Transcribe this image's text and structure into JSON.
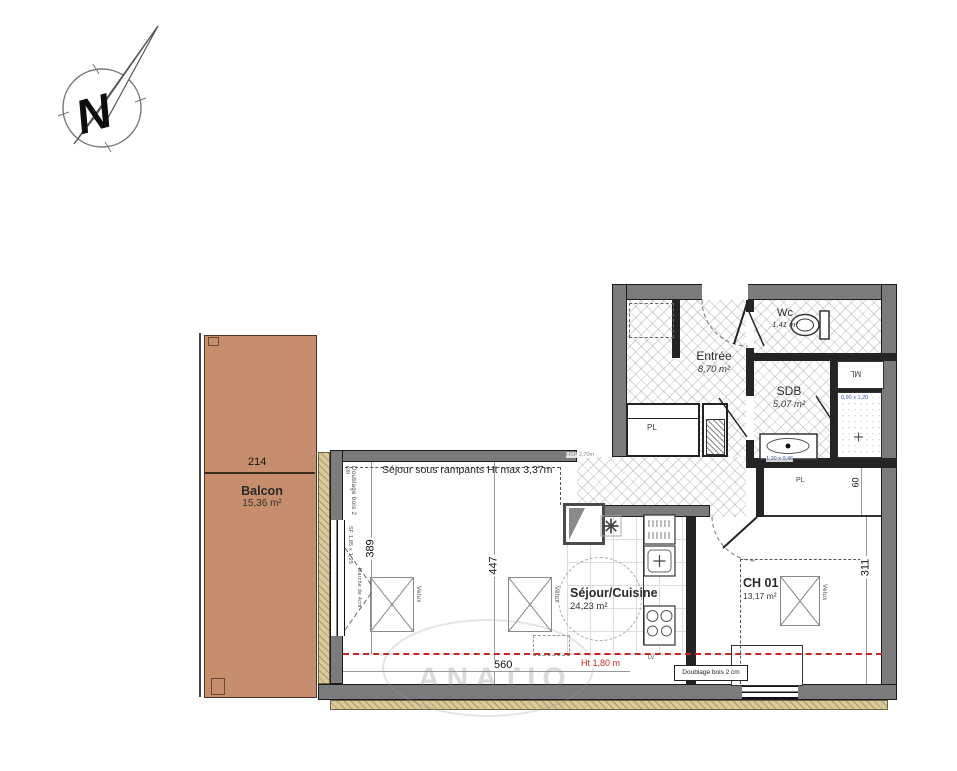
{
  "colors": {
    "balcony_fill": "#c68e6d",
    "wall_gray": "#7b7b7b",
    "insulation_tan": "#d9c99b",
    "red_dash": "#cc2222",
    "blue_dim": "#3a55a0"
  },
  "compass": {
    "letter": "N"
  },
  "rooms": {
    "balcon": {
      "name": "Balcon",
      "area": "15,36 m²"
    },
    "sejour": {
      "name": "Séjour/Cuisine",
      "area": "24,23 m²"
    },
    "ch01": {
      "name": "CH 01",
      "area": "13,17 m²"
    },
    "entree": {
      "name": "Entrée",
      "area": "8,70 m²"
    },
    "sdb": {
      "name": "SDB",
      "area": "5,07 m²"
    },
    "wc": {
      "name": "Wc",
      "area": "1,41 m²"
    }
  },
  "dimensions": {
    "balcon_width": "214",
    "sejour_left_depth": "389",
    "sejour_right_depth": "447",
    "sejour_width": "560",
    "ch01_depth": "311",
    "niche_depth": "60"
  },
  "annotations": {
    "rampants": "Séjour sous rampants  Ht max 3,37m",
    "height_line": "Ht 1,80 m",
    "ceiling_height": "HSP 2,70m",
    "doublage_left": "Doublage bois 2 cm",
    "doublage_right": "Doublage bois 2 cm",
    "window_size": "SF 1,85 x 1,25",
    "step": "Marche de 4cm",
    "velux": "Velux",
    "closet": "PL",
    "closet2": "PL",
    "washing_machine": "ML",
    "dishwasher": "LV",
    "shower_size": "0,90 x 1,20",
    "sink_size": "1,20 x 0,46",
    "watermark": "ANATIO"
  }
}
